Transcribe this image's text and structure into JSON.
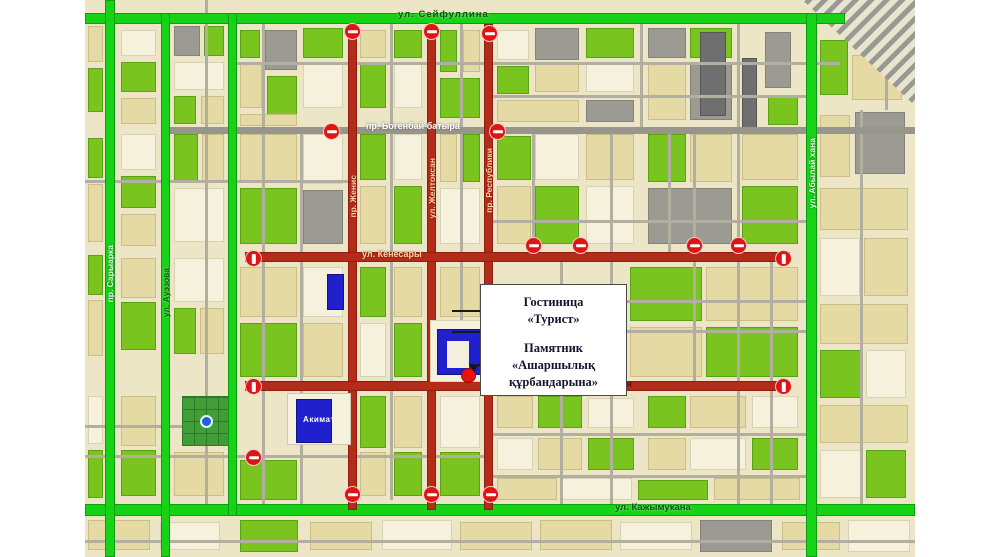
{
  "streets": {
    "top": "ул. Сейфуллина",
    "bogenbai": "пр. Богенбай батыра",
    "kenesary": "ул. Кенесары",
    "abaya": "ул. Абая",
    "kazhymukan": "ул. Кажымукана",
    "saryarka": "пр. Сарыарка",
    "auezov": "ул. Ауэзова",
    "abylaikhan": "ул. Абылай хана",
    "zhenis": "пр. Женис",
    "zheltoksan": "ул. Желтоксан",
    "respubliki": "пр. Республики"
  },
  "callout": {
    "hotel": "Гостиница\n«Турист»",
    "monument": "Памятник\n«Ашаршылық\nқұрбандарына»"
  },
  "buildings": {
    "akimat": "Акимат"
  },
  "colors": {
    "open_street": "#17d317",
    "closed_street": "#b32c1a",
    "regular_street": "#98968a",
    "no_entry_sign": "#e11414",
    "monument_marker": "#ea1111",
    "admin_building": "#2020cc",
    "land": "#ece5c6"
  }
}
